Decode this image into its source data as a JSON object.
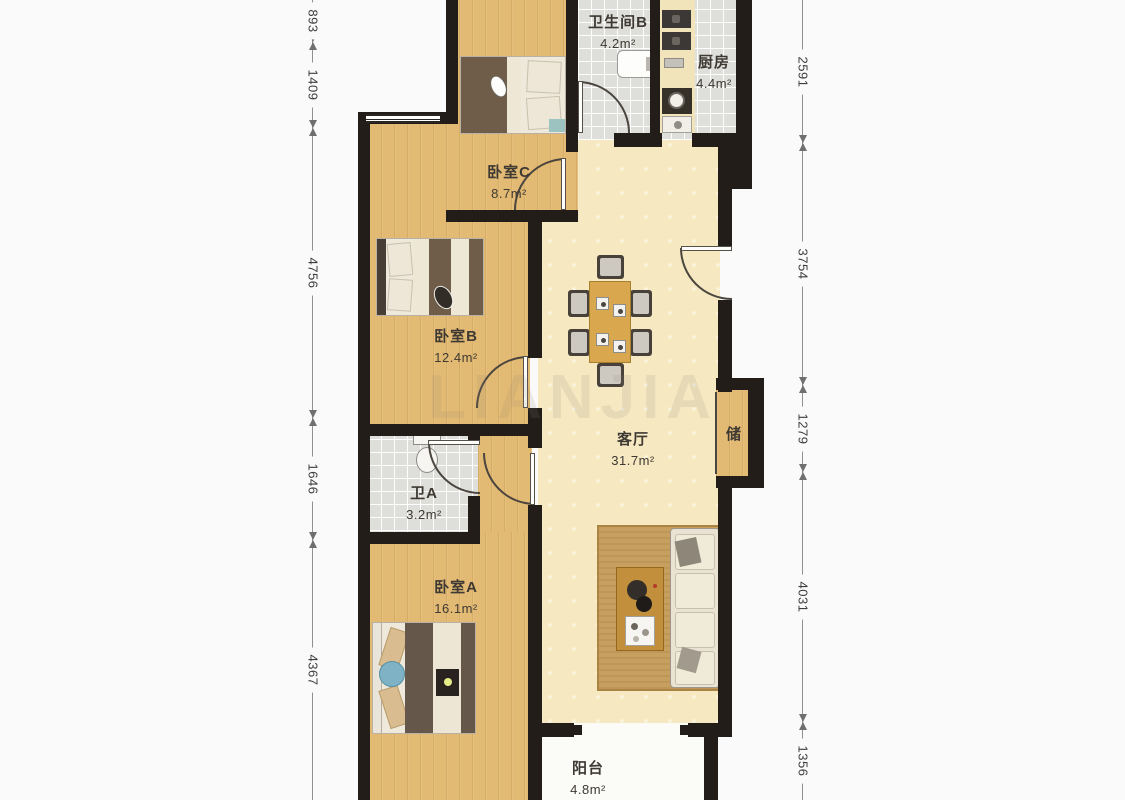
{
  "page": {
    "watermark": "LIANJIA"
  },
  "palette": {
    "wall": "#221d19",
    "wood_floor": "#e3ba73",
    "tile_floor": "#dededa",
    "living_floor": "#f6e8c0",
    "balcony_floor": "#fbfbf8",
    "counter": "#f1e4ba",
    "blanket": "#6f5d4a",
    "rug": "#c79f5e",
    "sofa": "#eae3d3",
    "dining_table": "#d8a74e",
    "dimension_line": "#909090",
    "label_text": "#3e3933"
  },
  "rooms": [
    {
      "name": "卫生间B",
      "area": "4.2m²"
    },
    {
      "name": "厨房",
      "area": "4.4m²"
    },
    {
      "name": "卧室C",
      "area": "8.7m²"
    },
    {
      "name": "卧室B",
      "area": "12.4m²"
    },
    {
      "name": "客厅",
      "area": "31.7m²"
    },
    {
      "name": "储",
      "area": ""
    },
    {
      "name": "卫A",
      "area": "3.2m²"
    },
    {
      "name": "卧室A",
      "area": "16.1m²"
    },
    {
      "name": "阳台",
      "area": "4.8m²"
    }
  ],
  "dimensions": {
    "left": [
      {
        "value": "893"
      },
      {
        "value": "1409"
      },
      {
        "value": "4756"
      },
      {
        "value": "1646"
      },
      {
        "value": "4367"
      }
    ],
    "right": [
      {
        "value": "2591"
      },
      {
        "value": "3754"
      },
      {
        "value": "1279"
      },
      {
        "value": "4031"
      },
      {
        "value": "1356"
      }
    ]
  }
}
